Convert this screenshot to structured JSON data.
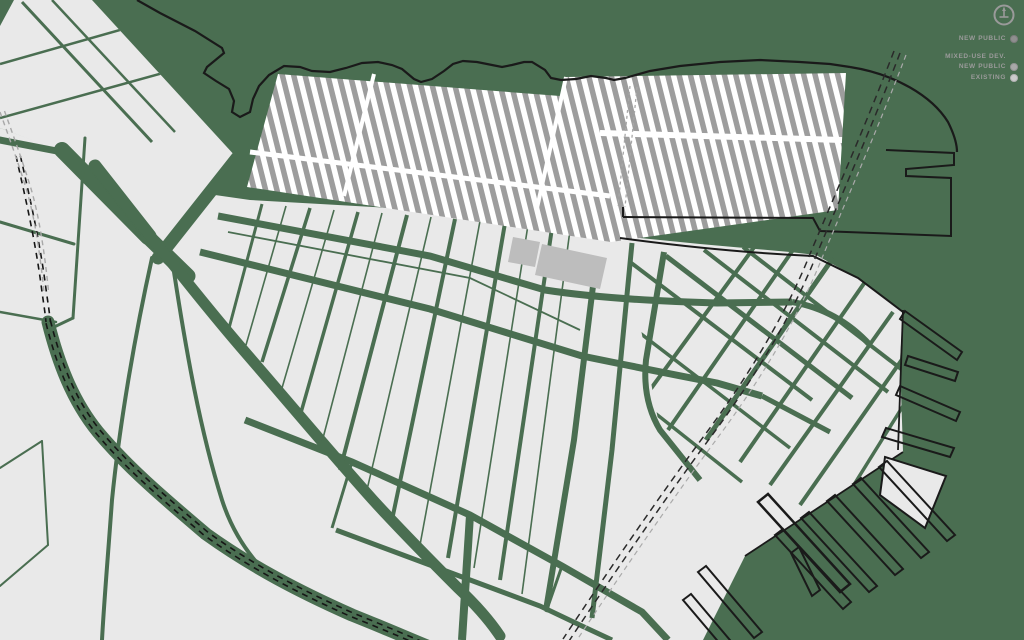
{
  "legend": {
    "items": [
      {
        "label": "NEW PUBLIC",
        "sublabel": "MIXED-USE DEV.",
        "dot_color": "#8f8f8f"
      },
      {
        "label": "NEW PUBLIC",
        "sublabel": "",
        "dot_color": "#a9a9a9"
      },
      {
        "label": "EXISTING",
        "sublabel": "",
        "dot_color": "#cbcbcb"
      }
    ]
  },
  "colors": {
    "background_green": "#4a6e51",
    "land_gray": "#e9e9e9",
    "hatch_stripe_gray": "#9d9d9d",
    "hatch_base_white": "#ffffff",
    "building_gray": "#bdbdbd",
    "line_black": "#1a1a1a",
    "dash_gray": "#a8a8a8",
    "legend_text_gray": "#9b9b9b"
  }
}
